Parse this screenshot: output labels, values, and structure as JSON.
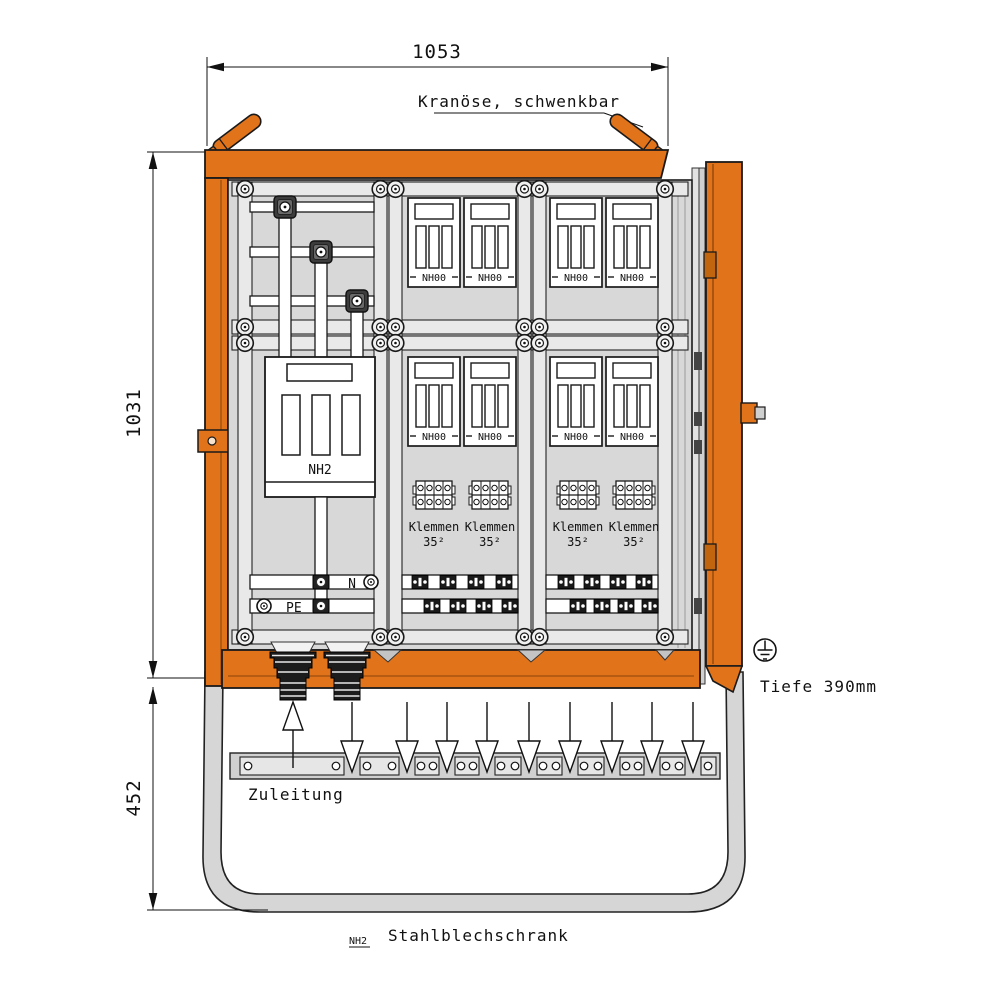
{
  "dimensions": {
    "width_mm": "1053",
    "body_height_mm": "1031",
    "stand_height_mm": "452",
    "depth": "Tiefe 390mm"
  },
  "annotations": {
    "crane_eye": "Kranöse, schwenkbar",
    "supply": "Zuleitung",
    "cabinet_type": "Stahlblechschrank",
    "cabinet_ref": "NH2"
  },
  "components": {
    "nh2_switch": "NH2",
    "nh00_fuse": "NH00",
    "terminal_label": "Klemmen",
    "terminal_size": "35²",
    "neutral": "N",
    "earth": "PE"
  },
  "colors": {
    "frame_orange": "#E1731B",
    "dark_orange": "#B85A10",
    "panel_grey": "#D8D8D8",
    "rail_grey": "#E9E9E9",
    "leg_grey": "#D6D6D6",
    "outline": "#1A1A1A"
  },
  "counts": {
    "nh00_modules": 8,
    "terminal_blocks": 4,
    "outgoing_arrows": 9,
    "cable_glands": 2
  }
}
